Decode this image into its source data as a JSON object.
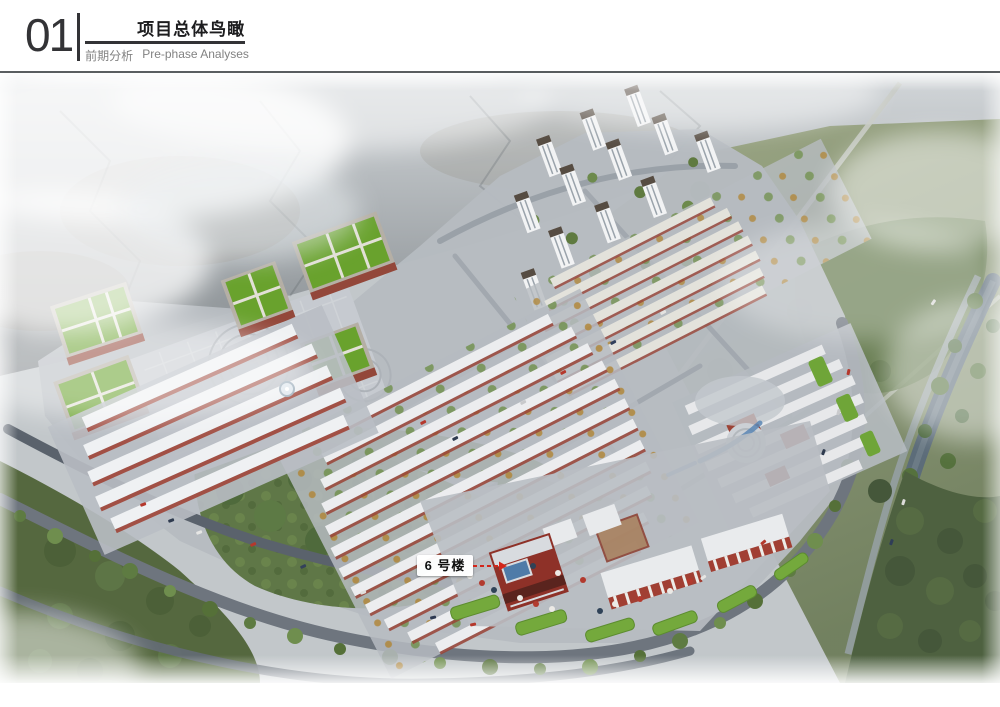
{
  "header": {
    "section_number": "01",
    "title": "项目总体鸟瞰",
    "subtitle_zh": "前期分析",
    "subtitle_en": "Pre-phase Analyses"
  },
  "annotation": {
    "building_label": "6 号楼"
  },
  "colors": {
    "header_text": "#333336",
    "subtitle_text": "#828282",
    "annotation_arrow": "#d3251a",
    "label_background": "#ffffff",
    "label_text": "#101010",
    "mountain_gray": "#83898d",
    "field_green": "#6e7d5a",
    "town_ground": "#b6bbc1",
    "roof_white": "#ecedef",
    "facade_red": "#9a4437",
    "school_roof_green": "#69a22d",
    "water_blue": "#5a86b4"
  }
}
